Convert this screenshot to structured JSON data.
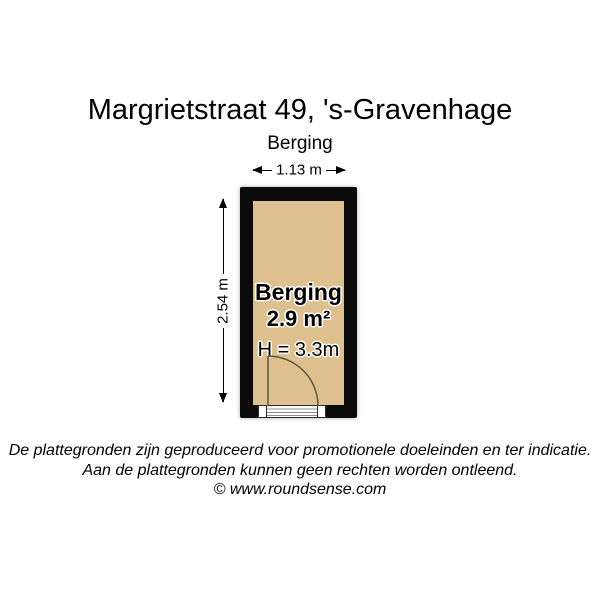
{
  "header": {
    "title": "Margrietstraat 49, 's-Gravenhage",
    "subtitle": "Berging"
  },
  "floorplan": {
    "room": {
      "label": "Berging",
      "area_label": "2.9 m²",
      "ceiling_height_label": "H = 3.3m"
    },
    "dimensions": {
      "width_label": "1.13 m",
      "depth_label": "2.54 m"
    },
    "colors": {
      "floor": "#dec08e",
      "wall": "#0b0b0b",
      "door_line": "#5d563f",
      "dimension_line": "#000000"
    }
  },
  "footer": {
    "disclaimer_line_1": "De plattegronden zijn geproduceerd voor promotionele doeleinden en ter indicatie.",
    "disclaimer_line_2": "Aan de plattegronden kunnen geen rechten worden ontleend.",
    "copyright": "© www.roundsense.com"
  }
}
